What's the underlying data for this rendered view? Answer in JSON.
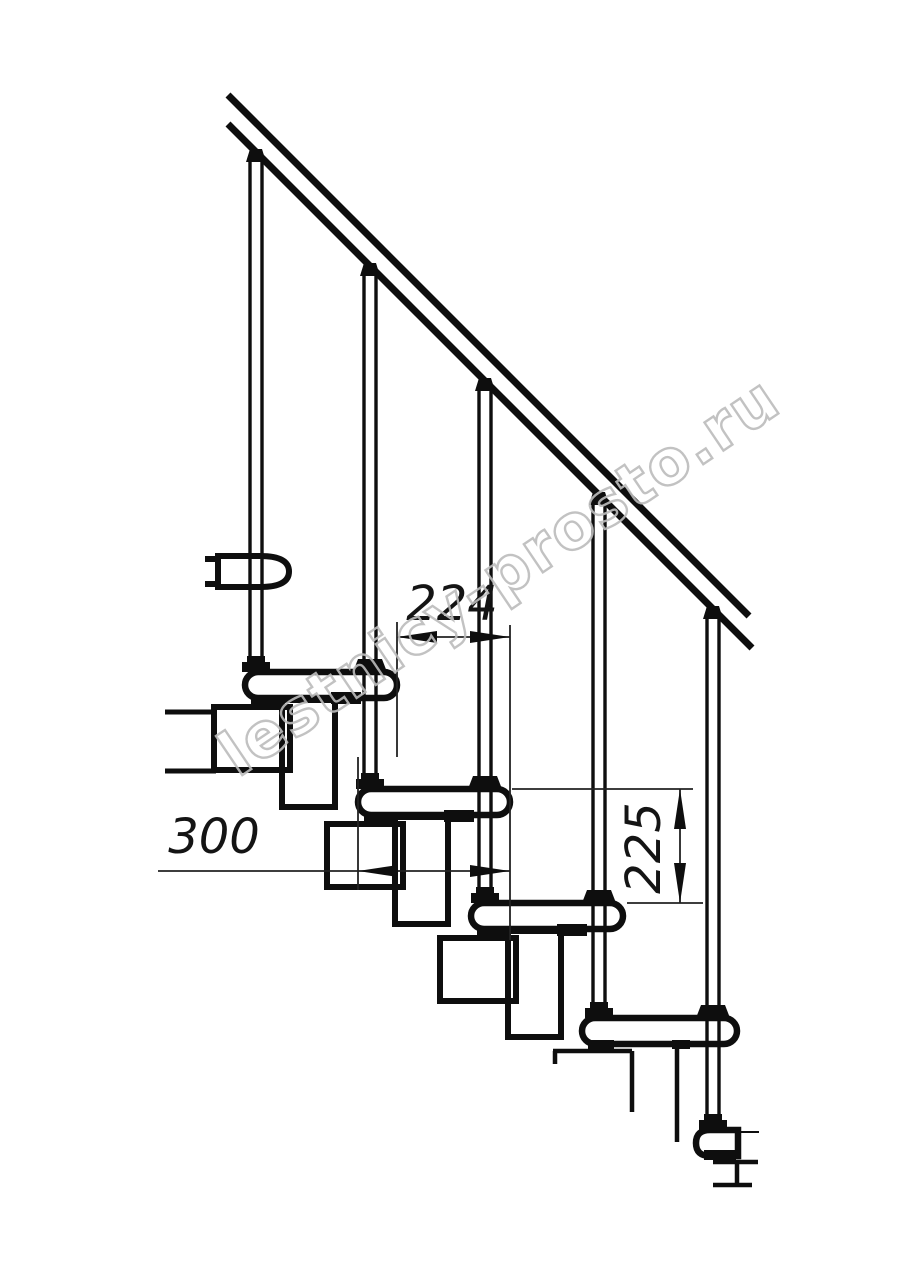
{
  "drawing": {
    "kind": "staircase-side-elevation",
    "watermark": {
      "text": "lestnicy-prosto.ru"
    },
    "dimensions": {
      "step_run_horizontal": "224",
      "tread_depth_horizontal": "300",
      "step_rise_vertical": "225"
    },
    "colors": {
      "ink": "#0e0e0e",
      "dim_line": "#222222",
      "watermark": "#bcbcbc",
      "background": "#ffffff"
    }
  }
}
